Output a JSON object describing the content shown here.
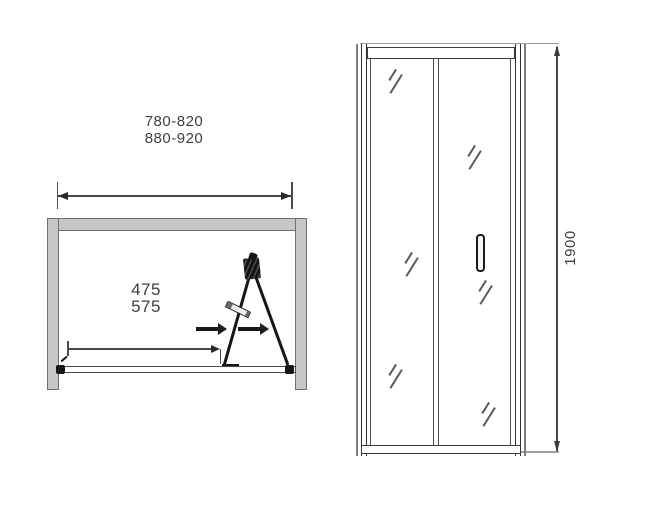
{
  "diagram": {
    "description": "Bi-fold shower door dimension drawing, plan view and front view"
  },
  "plan_view": {
    "width_range_line1": "780-820",
    "width_range_line2": "880-920",
    "fold_clearance_line1": "475",
    "fold_clearance_line2": "575",
    "open_direction_icon": "arrow-right"
  },
  "front_view": {
    "height_label": "1900"
  },
  "colors": {
    "wall_fill": "#c7c7c7",
    "wall_border": "#6f6f6f",
    "door_line": "#171717",
    "dimension_line": "#4a4a4a",
    "extension_line": "#9c9c9c",
    "glass_mark": "#5a5a5a",
    "text": "#3f3f3f"
  }
}
